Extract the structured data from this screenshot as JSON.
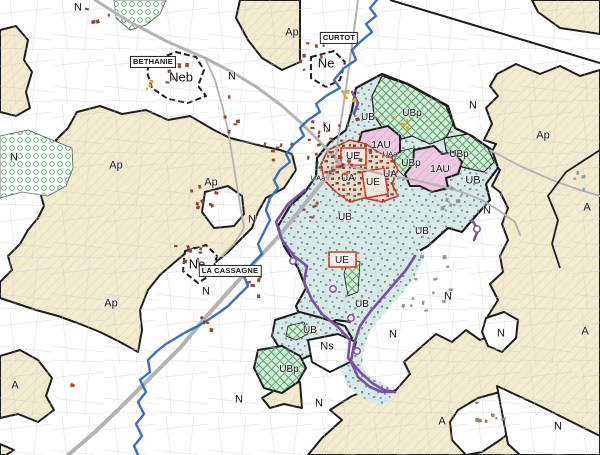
{
  "map": {
    "zone_labels": [
      {
        "text": "N",
        "x": 78,
        "y": 8,
        "v": "n"
      },
      {
        "text": "Ap",
        "x": 292,
        "y": 33,
        "v": "n"
      },
      {
        "text": "Neb",
        "x": 181,
        "y": 77,
        "v": "b"
      },
      {
        "text": "N",
        "x": 232,
        "y": 77,
        "v": "n"
      },
      {
        "text": "Ne",
        "x": 326,
        "y": 63,
        "v": "b"
      },
      {
        "text": "N",
        "x": 327,
        "y": 129,
        "v": "n"
      },
      {
        "text": "N",
        "x": 473,
        "y": 106,
        "v": "n"
      },
      {
        "text": "Ap",
        "x": 543,
        "y": 136,
        "v": "n"
      },
      {
        "text": "N",
        "x": 14,
        "y": 158,
        "v": "n"
      },
      {
        "text": "Ap",
        "x": 116,
        "y": 166,
        "v": "n"
      },
      {
        "text": "Ap",
        "x": 211,
        "y": 183,
        "v": "n"
      },
      {
        "text": "UB",
        "x": 368,
        "y": 118,
        "v": "s"
      },
      {
        "text": "UBp",
        "x": 412,
        "y": 114,
        "v": "s"
      },
      {
        "text": "1AU",
        "x": 381,
        "y": 146,
        "v": "s"
      },
      {
        "text": "UAa",
        "x": 390,
        "y": 154,
        "v": "xs"
      },
      {
        "text": "UE",
        "x": 353,
        "y": 157,
        "v": "s"
      },
      {
        "text": "UBp",
        "x": 459,
        "y": 155,
        "v": "s"
      },
      {
        "text": "UBp",
        "x": 411,
        "y": 164,
        "v": "s"
      },
      {
        "text": "1AU",
        "x": 440,
        "y": 170,
        "v": "s"
      },
      {
        "text": "UAa",
        "x": 318,
        "y": 178,
        "v": "xs"
      },
      {
        "text": "UA",
        "x": 348,
        "y": 179,
        "v": "s"
      },
      {
        "text": "UE",
        "x": 373,
        "y": 183,
        "v": "s"
      },
      {
        "text": "UA",
        "x": 390,
        "y": 175,
        "v": "s"
      },
      {
        "text": "UB",
        "x": 473,
        "y": 181,
        "v": "n"
      },
      {
        "text": "N",
        "x": 487,
        "y": 211,
        "v": "n"
      },
      {
        "text": "A",
        "x": 587,
        "y": 208,
        "v": "n"
      },
      {
        "text": "UB",
        "x": 345,
        "y": 218,
        "v": "s"
      },
      {
        "text": "UB",
        "x": 422,
        "y": 232,
        "v": "s"
      },
      {
        "text": "N",
        "x": 252,
        "y": 220,
        "v": "n"
      },
      {
        "text": "Ne",
        "x": 197,
        "y": 264,
        "v": "b"
      },
      {
        "text": "N",
        "x": 206,
        "y": 292,
        "v": "n"
      },
      {
        "text": "Ap",
        "x": 111,
        "y": 304,
        "v": "n"
      },
      {
        "text": "UE",
        "x": 342,
        "y": 261,
        "v": "s"
      },
      {
        "text": "UB",
        "x": 362,
        "y": 305,
        "v": "s"
      },
      {
        "text": "UB",
        "x": 310,
        "y": 331,
        "v": "s"
      },
      {
        "text": "Ns",
        "x": 327,
        "y": 347,
        "v": "n"
      },
      {
        "text": "UBp",
        "x": 289,
        "y": 370,
        "v": "s"
      },
      {
        "text": "N",
        "x": 448,
        "y": 297,
        "v": "n"
      },
      {
        "text": "N",
        "x": 393,
        "y": 335,
        "v": "n"
      },
      {
        "text": "N",
        "x": 501,
        "y": 334,
        "v": "n"
      },
      {
        "text": "A",
        "x": 585,
        "y": 332,
        "v": "n"
      },
      {
        "text": "A",
        "x": 15,
        "y": 386,
        "v": "n"
      },
      {
        "text": "N",
        "x": 239,
        "y": 400,
        "v": "n"
      },
      {
        "text": "N",
        "x": 319,
        "y": 404,
        "v": "n"
      },
      {
        "text": "A",
        "x": 442,
        "y": 422,
        "v": "n"
      },
      {
        "text": "N",
        "x": 558,
        "y": 427,
        "v": "n"
      }
    ],
    "place_labels": [
      {
        "text": "BETHANIE",
        "x": 153,
        "y": 62
      },
      {
        "text": "CURTOT",
        "x": 339,
        "y": 38
      },
      {
        "text": "LA CASSAGNE",
        "x": 230,
        "y": 271
      }
    ],
    "colors": {
      "zone_a_ap": "#f3ebd0",
      "zone_ub": "#d6ebe8",
      "zone_ubp_hatch": "#4aa45c",
      "zone_1au": "#f2c8e1",
      "zone_ue_outline": "#d43425",
      "zone_ua_outline": "#c0392b",
      "river": "#3f6fb8",
      "road": "#b3b3b3",
      "boundary": "#1c1c1c",
      "overlay_purple": "#7a4fa3"
    }
  }
}
